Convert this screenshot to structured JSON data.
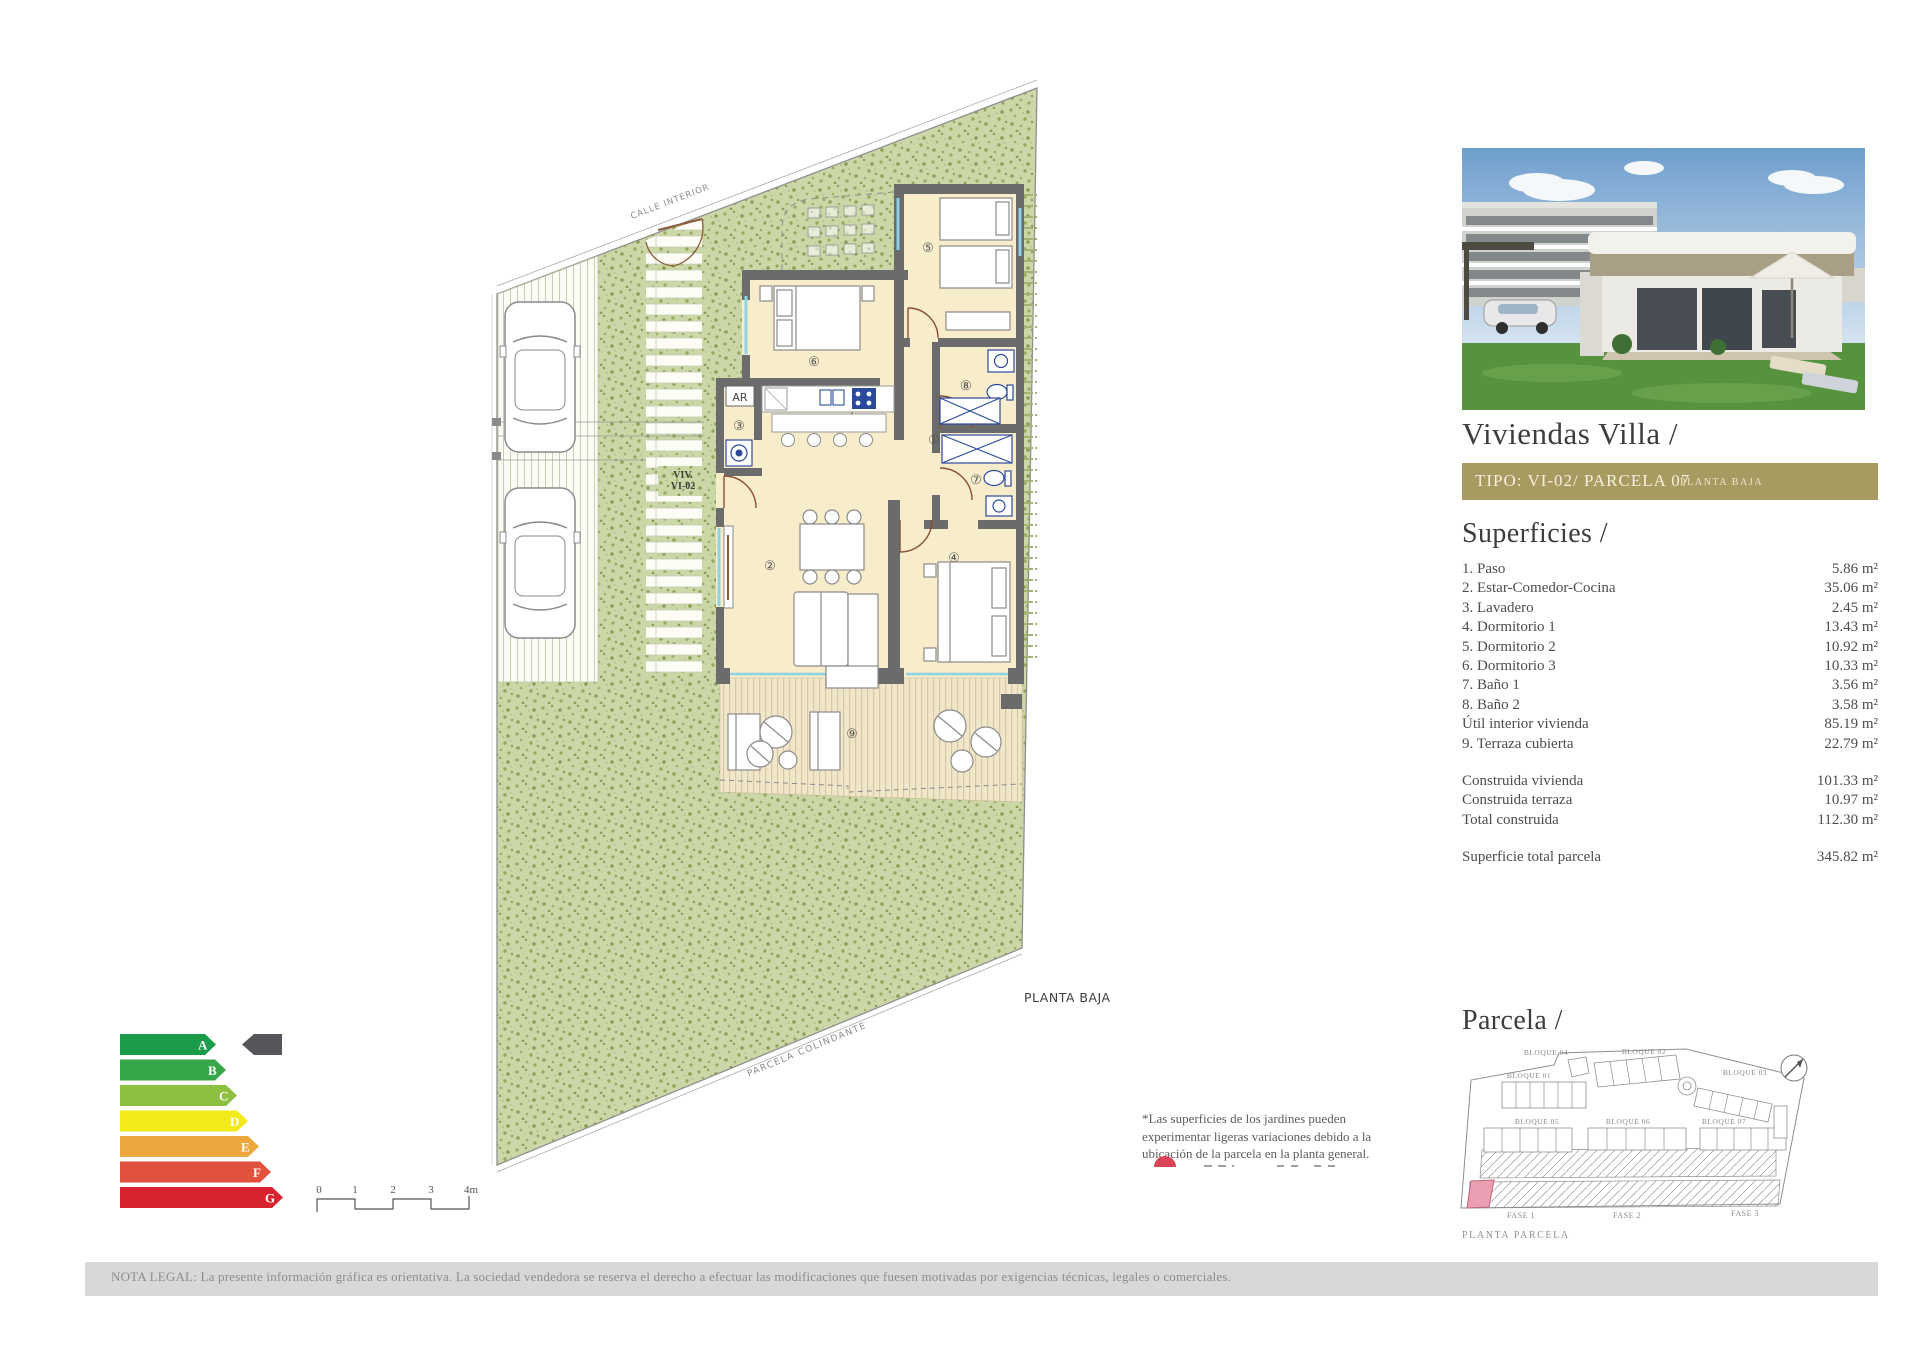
{
  "plan": {
    "street_label": "CALLE INTERIOR",
    "unit_label_line1": "VIV.",
    "unit_label_line2": "VI-02",
    "adjacent_label": "PARCELA COLINDANTE",
    "floor_label": "PLANTA BAJA",
    "storage_label": "AR",
    "rooms": [
      "①",
      "②",
      "③",
      "④",
      "⑤",
      "⑥",
      "⑦",
      "⑧",
      "⑨"
    ]
  },
  "panel": {
    "title": "Viviendas Villa /",
    "bar": {
      "main": "TIPO: VI-02/ PARCELA 07",
      "sub": "PLANTA BAJA",
      "bg": "#a89b62"
    },
    "superficies_heading": "Superficies /",
    "rows": [
      {
        "label": "1. Paso",
        "value": "5.86 m²"
      },
      {
        "label": "2. Estar-Comedor-Cocina",
        "value": "35.06 m²"
      },
      {
        "label": "3. Lavadero",
        "value": "2.45 m²"
      },
      {
        "label": "4. Dormitorio 1",
        "value": "13.43 m²"
      },
      {
        "label": "5. Dormitorio 2",
        "value": "10.92 m²"
      },
      {
        "label": "6. Dormitorio 3",
        "value": "10.33 m²"
      },
      {
        "label": "7. Baño 1",
        "value": "3.56 m²"
      },
      {
        "label": "8. Baño 2",
        "value": "3.58 m²"
      },
      {
        "label": "Útil interior vivienda",
        "value": "85.19 m²"
      },
      {
        "label": "9. Terraza cubierta",
        "value": "22.79 m²"
      }
    ],
    "construida": [
      {
        "label": "Construida vivienda",
        "value": "101.33 m²"
      },
      {
        "label": "Construida terraza",
        "value": "10.97 m²"
      },
      {
        "label": "Total construida",
        "value": "112.30 m²"
      }
    ],
    "total": {
      "label": "Superficie total parcela",
      "value": "345.82 m²"
    },
    "parcela_heading": "Parcela /",
    "planta_parcela": "PLANTA PARCELA",
    "bloques": [
      "BLOQUE 01",
      "BLOQUE 02",
      "BLOQUE 03",
      "BLOQUE 04",
      "BLOQUE 05",
      "BLOQUE 06",
      "BLOQUE 07"
    ],
    "fases": [
      "FASE 1",
      "FASE 2",
      "FASE 3"
    ],
    "highlight_color": "#ec9fb3"
  },
  "energy": {
    "letters": [
      "A",
      "B",
      "C",
      "D",
      "E",
      "F",
      "G"
    ],
    "colors": [
      "#1a9c4b",
      "#37a649",
      "#8dc040",
      "#f2ea19",
      "#eca83f",
      "#e2513b",
      "#d8232f"
    ],
    "indicator": "#55565a"
  },
  "scalebar": {
    "ticks": [
      "0",
      "1",
      "2",
      "3",
      "4m"
    ]
  },
  "note": {
    "text": "*Las superficies de los jardines pueden experimentar ligeras variaciones debido a la ubicación de la parcela en la planta general.",
    "legend_color": "#d84356"
  },
  "legal": {
    "text": "NOTA LEGAL: La presente información gráfica es orientativa. La sociedad vendedora se reserva el derecho a efectuar las modificaciones que fuesen motivadas por exigencias técnicas, legales o comerciales."
  }
}
